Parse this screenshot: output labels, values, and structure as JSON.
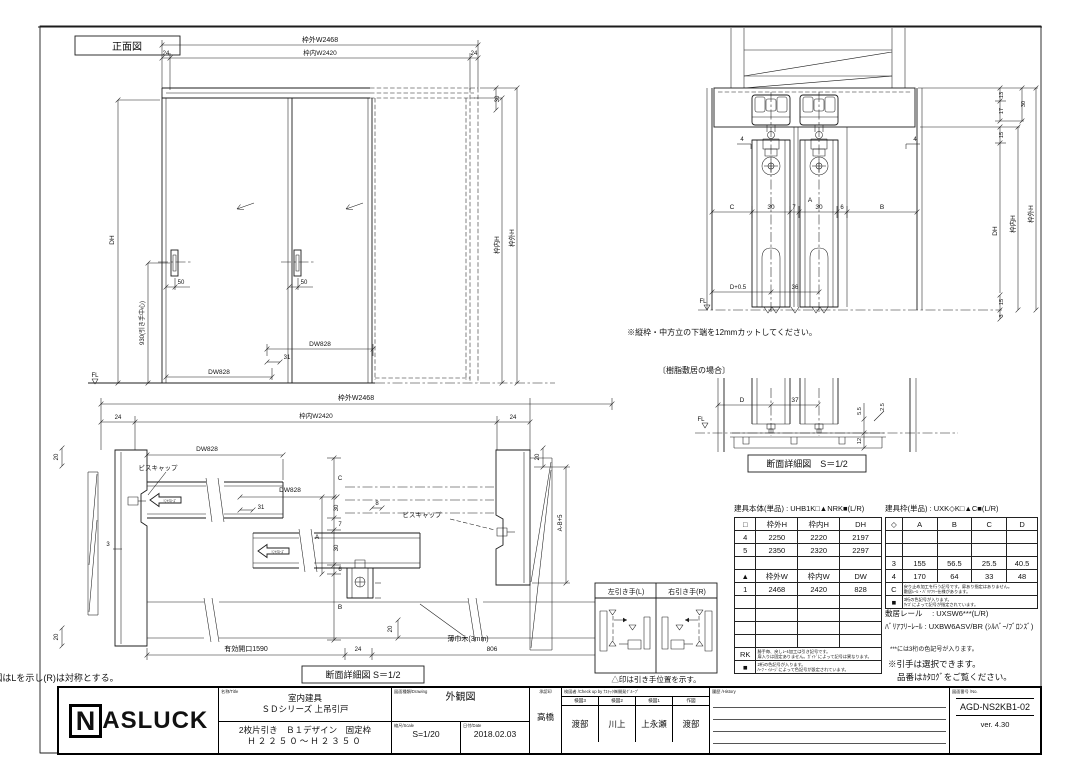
{
  "page": {
    "bg": "#ffffff",
    "ink": "#1c1c1c"
  },
  "fv": {
    "title": "正面図",
    "outer_w": "枠外W2468",
    "inner_w": "枠内W2420",
    "n24l": "24",
    "n24r": "24",
    "dh": "DH",
    "n930": "930(引き手中心)",
    "n50l": "50",
    "n50r": "50",
    "dw_up": "DW828",
    "dw_low": "DW828",
    "n31": "31",
    "n30": "30",
    "inner_h": "枠内H",
    "outer_h": "枠外H",
    "fl": "FL"
  },
  "sv": {
    "n4l": "4",
    "n4r": "4",
    "c": "C",
    "n30a": "30",
    "n7": "7",
    "n30b": "30",
    "n6": "6",
    "b": "B",
    "a": "A",
    "dp05": "D+0.5",
    "n36": "36",
    "n13": "13",
    "n17": "17",
    "n15": "15",
    "n30r": "30",
    "dh": "DH",
    "inner_h": "枠内H",
    "outer_h": "枠外H",
    "n15b": "15",
    "n3": "3",
    "fl": "FL",
    "note": "※縦枠・中方立の下端を12mmカットしてください。"
  },
  "sd": {
    "title": "〔樹脂敷居の場合〕",
    "d": "D",
    "n37": "37",
    "n55": "5.5",
    "n25": "2.5",
    "n12": "12",
    "fl": "FL",
    "caption": "断面詳細図　S＝1/2"
  },
  "pv": {
    "outer_w": "枠外W2468",
    "inner_w": "枠内W2420",
    "n24l": "24",
    "n24r": "24",
    "n20tl": "20",
    "n20bl": "20",
    "n20tr": "20",
    "n20bb": "20",
    "dw1": "DW828",
    "dw2": "DW828",
    "n31": "31",
    "n3": "3",
    "n8": "8",
    "cap1": "ビスキャップ",
    "cap2": "ビスキャップ",
    "soft": "ｿﾌﾄｸﾛｰｽﾞ",
    "chain": {
      "c": "C",
      "n30a": "30",
      "n7": "7",
      "a": "A",
      "n30b": "30",
      "n6": "6",
      "b": "B"
    },
    "ab5": "A-B+5",
    "baseboard": "薄巾木(3mm)",
    "opening": "有効開口1590",
    "n24b": "24",
    "n806": "806",
    "caption": "断面詳細図 S＝1/2",
    "note": "※本図はLを示し(R)は対称とする。"
  },
  "hb": {
    "left": "左引き手(L)",
    "right": "右引き手(R)",
    "caption": "△印は引き手位置を示す。"
  },
  "body_table": {
    "title": "建具本体(単品) : UHB1K□▲NRK■(L/R)",
    "rows": [
      [
        "□",
        "枠外H",
        "枠内H",
        "DH"
      ],
      [
        "4",
        "2250",
        "2220",
        "2197"
      ],
      [
        "5",
        "2350",
        "2320",
        "2297"
      ],
      [
        "",
        "",
        "",
        ""
      ],
      [
        "▲",
        "枠外W",
        "枠内W",
        "DW"
      ],
      [
        "1",
        "2468",
        "2420",
        "828"
      ],
      [
        "",
        "",
        "",
        ""
      ],
      [
        "",
        "",
        "",
        ""
      ],
      [
        "",
        "",
        "",
        ""
      ],
      [
        "",
        "",
        "",
        ""
      ]
    ],
    "note_rows": [
      {
        "key": "RK",
        "line1": "勝手毎、戻しﾚｰﾙ加工は引き記号です。",
        "line2": "扉入りは固定ありません。ｶﾞｲﾄﾞによって記号は異なります。"
      },
      {
        "key": "■",
        "line1": "2桁の色記号が入ります。",
        "line2": "ﾊｰﾌ・ｲﾒｰｼﾞによって色記号が設定されています。"
      }
    ]
  },
  "frame_table": {
    "title": "建具枠(単品) : UXK◇K□▲C■(L/R)",
    "rows": [
      [
        "◇",
        "A",
        "B",
        "C",
        "D"
      ],
      [
        "",
        "",
        "",
        "",
        ""
      ],
      [
        "",
        "",
        "",
        "",
        ""
      ],
      [
        "3",
        "155",
        "56.5",
        "25.5",
        "40.5"
      ],
      [
        "4",
        "170",
        "64",
        "33",
        "48"
      ]
    ],
    "note_rows": [
      {
        "key": "C",
        "line1": "戻り止め加工を行う記号です。扉あり指定はありません。",
        "line2": "敷居ﾚｰﾙ・ﾊﾞﾘｱﾌﾘｰ仕様があります。"
      },
      {
        "key": "■",
        "line1": "3桁の色記号が入ります。",
        "line2": "ｻｲｽﾞによって記号が指定されています。"
      }
    ],
    "rail1": "敷居レール　 : UXSW6***(L/R)",
    "rail2": "ﾊﾞﾘｱﾌﾘｰﾚｰﾙ : UXBW6ASV/BR (ｼﾙﾊﾞｰ/ﾌﾞﾛﾝｽﾞ)",
    "note1": "***には3桁の色記号が入ります。",
    "note2": "※引手は選択できます。",
    "note3": "品番はｶﾀﾛｸﾞをご覧ください。"
  },
  "title_block": {
    "logo_n": "N",
    "logo_rest": "ASLUCK",
    "name_header": "名称/Title",
    "name_line1": "室内建具",
    "name_line2": "ＳＤシリーズ 上吊引戸",
    "name_line3": "2枚片引き　Ｂ１デザイン　固定枠",
    "name_line4": "Ｈ２２５０～Ｈ２３５０",
    "drawing_header": "図面種類/Drawing",
    "drawing_type": "外観図",
    "scale_header": "縮尺/Scale",
    "scale": "S=1/20",
    "date_header": "日付/Date",
    "date": "2018.02.03",
    "approve_header": "承認印",
    "approver": "高橋",
    "check_header": "検図者 /Check up by ﾅｽﾗｯｸ㈱開発ｸﾞﾙｰﾌﾟ",
    "check_cols": [
      {
        "label": "検図3",
        "name": "渡部"
      },
      {
        "label": "検図2",
        "name": "川上"
      },
      {
        "label": "検図1",
        "name": "上永瀬"
      },
      {
        "label": "作図",
        "name": "渡部"
      }
    ],
    "history_header": "履歴 /History",
    "number_header": "図面番号 /No.",
    "number": "AGD-NS2KB1-02",
    "version": "ver. 4.30"
  }
}
